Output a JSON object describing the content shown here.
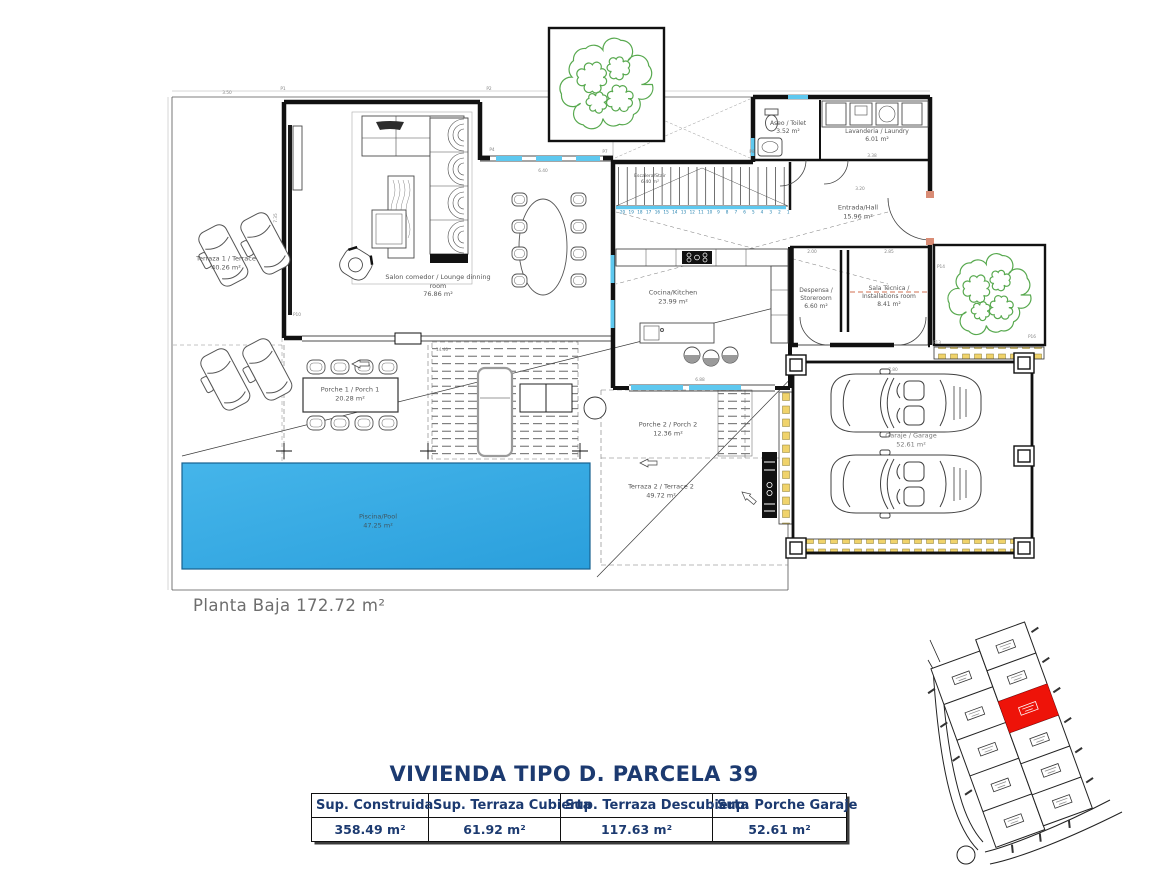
{
  "floor_label": "Planta Baja 172.72 m²",
  "title": "VIVIENDA TIPO D. PARCELA 39",
  "summary_table": {
    "columns": [
      {
        "header": "Sup. Construida",
        "value": "358.49 m²"
      },
      {
        "header": "Sup. Terraza Cubierta",
        "value": "61.92 m²"
      },
      {
        "header": "Sup. Terraza Descubierta",
        "value": "117.63 m²"
      },
      {
        "header": "Sup. Porche Garaje",
        "value": "52.61 m²"
      }
    ]
  },
  "rooms": [
    {
      "name": "Terraza 1 / Terrace",
      "area": "40.26 m²"
    },
    {
      "name": "Salon comedor / Lounge dinning room",
      "area": "76.86 m²"
    },
    {
      "name": "Escalera/Stair",
      "area": "6.40 m²"
    },
    {
      "name": "Aseo / Toilet",
      "area": "3.52 m²"
    },
    {
      "name": "Lavanderia / Laundry",
      "area": "6.01 m²"
    },
    {
      "name": "Entrada/Hall",
      "area": "15.96 m²"
    },
    {
      "name": "Cocina/Kitchen",
      "area": "23.99 m²"
    },
    {
      "name": "Despensa / Storeroom",
      "area": "6.60 m²"
    },
    {
      "name": "Sala Técnica / Installations room",
      "area": "8.41 m²"
    },
    {
      "name": "Porche 1 / Porch 1",
      "area": "20.28 m²"
    },
    {
      "name": "Porche 2 / Porch 2",
      "area": "12.36 m²"
    },
    {
      "name": "Terraza 2 / Terrace 2",
      "area": "49.72 m²"
    },
    {
      "name": "Piscina/Pool",
      "area": "47.25 m²"
    },
    {
      "name": "Garaje / Garage",
      "area": "52.61 m²"
    }
  ],
  "plan": {
    "stair_step_numbers": "20 19 18 17 16 15 14 13 12 11 10 9 8 7 6 5 4 3 2 1",
    "dims": [
      {
        "t": "3.50",
        "x": 227,
        "y": 94,
        "r": 0
      },
      {
        "t": "P1",
        "x": 283,
        "y": 90,
        "r": 0
      },
      {
        "t": "P2",
        "x": 489,
        "y": 90,
        "r": 0
      },
      {
        "t": "P4",
        "x": 492,
        "y": 151,
        "r": 0
      },
      {
        "t": "P7",
        "x": 605,
        "y": 153,
        "r": 0
      },
      {
        "t": "P8",
        "x": 752,
        "y": 153,
        "r": 0
      },
      {
        "t": "P10",
        "x": 297,
        "y": 316,
        "r": 0
      },
      {
        "t": "7.35",
        "x": 277,
        "y": 218,
        "r": -90
      },
      {
        "t": "6.40",
        "x": 543,
        "y": 172,
        "r": 0
      },
      {
        "t": "3.38",
        "x": 872,
        "y": 157,
        "r": 0
      },
      {
        "t": "3.20",
        "x": 860,
        "y": 190,
        "r": 0
      },
      {
        "t": "2.00",
        "x": 812,
        "y": 253,
        "r": 0
      },
      {
        "t": "2.85",
        "x": 889,
        "y": 253,
        "r": 0
      },
      {
        "t": "14.40",
        "x": 442,
        "y": 351,
        "r": 0
      },
      {
        "t": "6.88",
        "x": 700,
        "y": 381,
        "r": 0
      },
      {
        "t": "7.80",
        "x": 893,
        "y": 371,
        "r": 0
      },
      {
        "t": "P13",
        "x": 937,
        "y": 344,
        "r": 0
      },
      {
        "t": "P14",
        "x": 941,
        "y": 268,
        "r": 0
      },
      {
        "t": "P16",
        "x": 1032,
        "y": 338,
        "r": 0
      }
    ]
  },
  "colors": {
    "title_navy": "#1c3a70",
    "pool_blue": "#2fa9e2",
    "window_blue": "#5ec8ef",
    "tree_green": "#58a94f",
    "hatch_yellow": "#f0d36b",
    "parcel_red": "#ee1309",
    "door_salmon": "#d98c75"
  }
}
